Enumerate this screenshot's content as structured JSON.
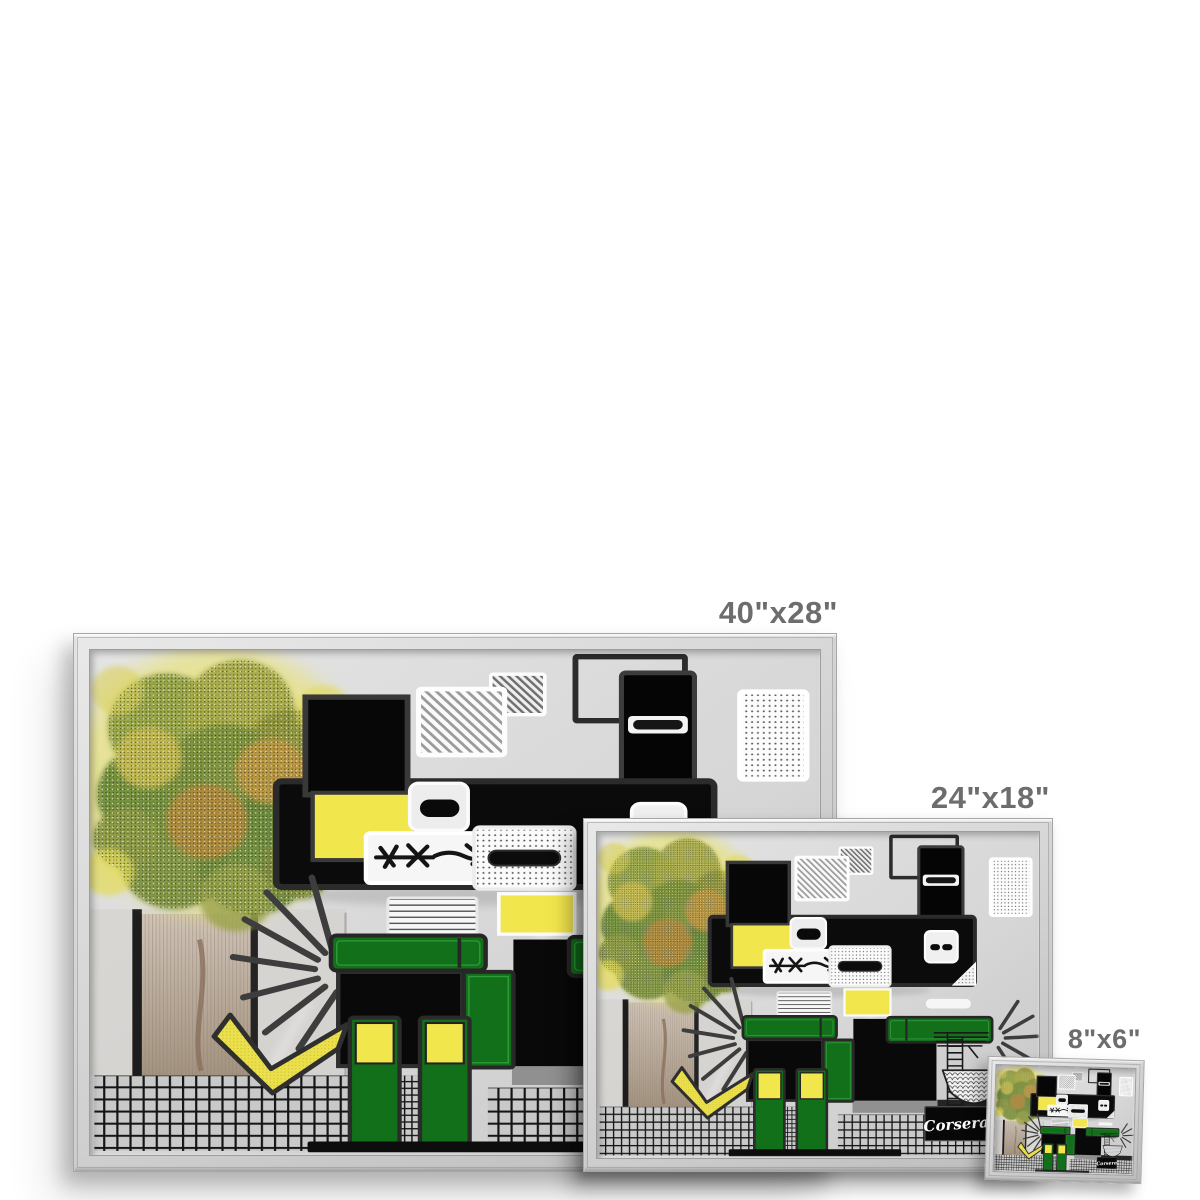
{
  "page": {
    "background_color": "#ffffff"
  },
  "product_mockup": {
    "sizes": [
      {
        "id": "40x28",
        "label": "40\"x28\""
      },
      {
        "id": "24x18",
        "label": "24\"x18\""
      },
      {
        "id": "8x6",
        "label": "8\"x6\""
      }
    ],
    "size_label_color": "#6d6d6d",
    "frame_color": "#d5d5d5"
  },
  "artwork": {
    "signature": "Corsera",
    "palette": {
      "canvas_gray": "#d6d6d6",
      "block_black": "#0a0a0a",
      "accent_yellow": "#f2e64d",
      "accent_green": "#13701a",
      "foliage_green": "#7c923e",
      "foliage_olive": "#b08a3c",
      "trunk_brown": "#a3927f"
    }
  }
}
